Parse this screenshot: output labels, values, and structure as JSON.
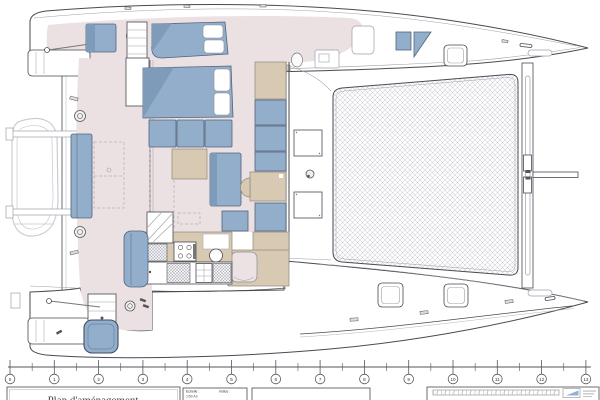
{
  "drawing": {
    "title": "Plan d'aménagement",
    "fields": {
      "scale_label": "Echelle :",
      "scale_value": "1/50 A3",
      "index_label": "Indice :"
    },
    "ruler": {
      "marks": [
        "0",
        "1",
        "2",
        "3",
        "4",
        "5",
        "6",
        "7",
        "8",
        "9",
        "10",
        "11",
        "12",
        "13"
      ]
    },
    "colors": {
      "floor": "#ebe1e3",
      "furniture_blue": "#93aecb",
      "furniture_blue_dark": "#7e9bba",
      "wood_tan": "#d8cab2",
      "outline": "#4a4a52",
      "light_line": "#9aa0a8",
      "ghost": "#c8c9ce",
      "tramp_line": "#c0c3ca",
      "logo_blue": "#7fa3c9"
    }
  }
}
